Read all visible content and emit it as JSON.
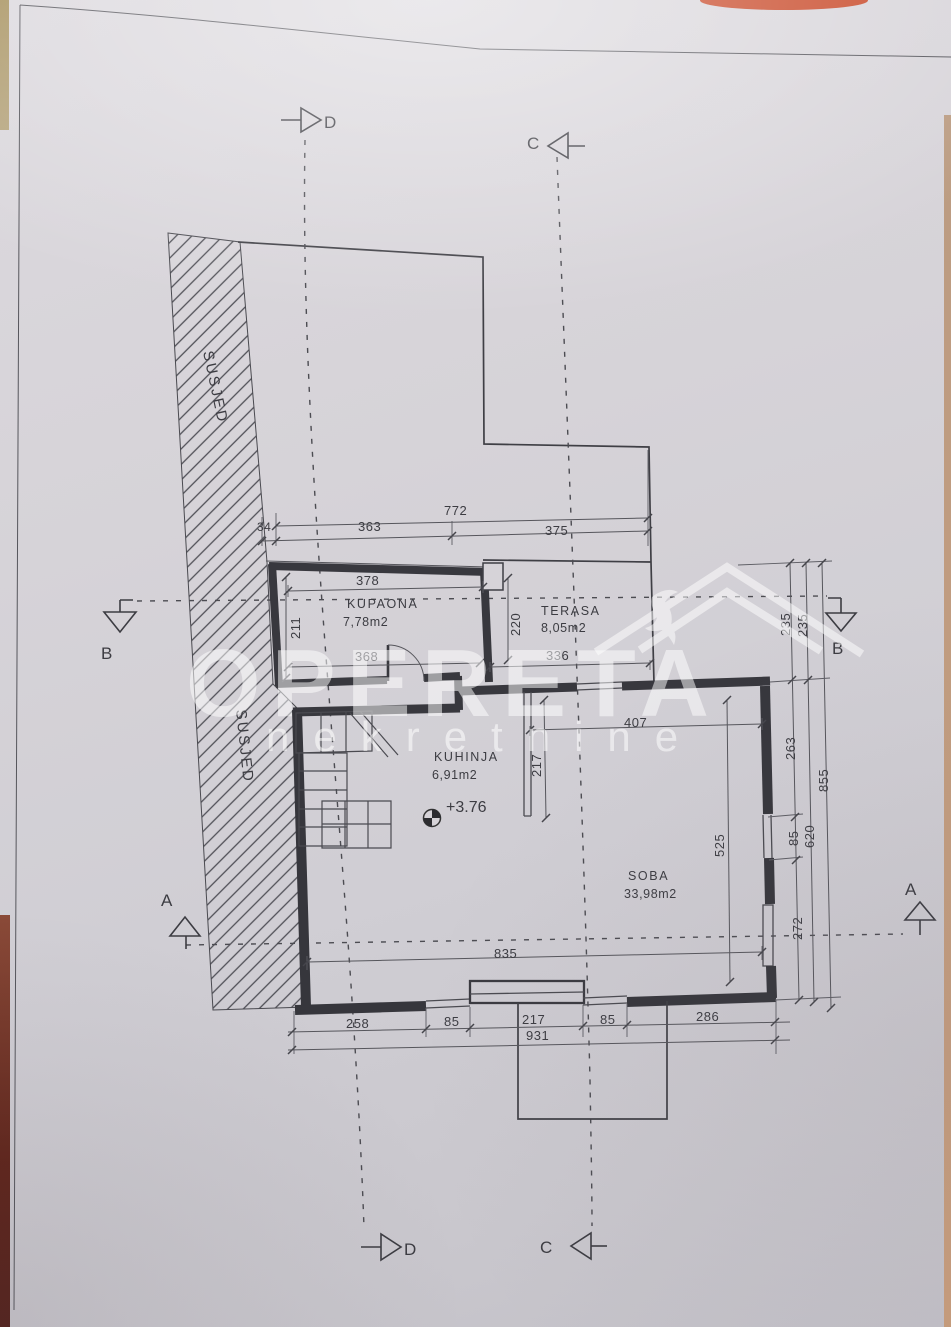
{
  "watermark": {
    "brand": "OPERETA",
    "subtitle": "nekretnine"
  },
  "site": {
    "neighbor": "SUSJED"
  },
  "rooms": {
    "kupaona": {
      "name": "KUPAONA",
      "area": "7,78m2"
    },
    "terasa": {
      "name": "TERASA",
      "area": "8,05m2"
    },
    "kuhinja": {
      "name": "KUHINJA",
      "area": "6,91m2"
    },
    "soba": {
      "name": "SOBA",
      "area": "33,98m2"
    }
  },
  "elevation": {
    "value": "+3.76"
  },
  "markers": {
    "top_d": "D",
    "top_c": "C",
    "bottom_d": "D",
    "bottom_c": "C",
    "left_b": "B",
    "right_b": "B",
    "left_a": "A",
    "right_a": "A"
  },
  "dims": {
    "d34": "34",
    "d772": "772",
    "d363": "363",
    "d375": "375",
    "d378": "378",
    "d211": "211",
    "d368": "368",
    "d220": "220",
    "d336": "336",
    "d407": "407",
    "d217": "217",
    "d525": "525",
    "d835": "835",
    "r235a": "235",
    "r235b": "235",
    "r263": "263",
    "r85": "85",
    "r272": "272",
    "r620": "620",
    "r855": "855",
    "b258": "258",
    "b85a": "85",
    "b217": "217",
    "b85b": "85",
    "b286": "286",
    "b931": "931"
  },
  "colors": {
    "paper": "#d6d3d8",
    "ink": "#38383e",
    "watermark": "#ffffff",
    "edge_olive": "#a7925f",
    "edge_maroon": "#5f241a",
    "edge_tan": "#c89d7c",
    "edge_red": "#c94b2b"
  }
}
